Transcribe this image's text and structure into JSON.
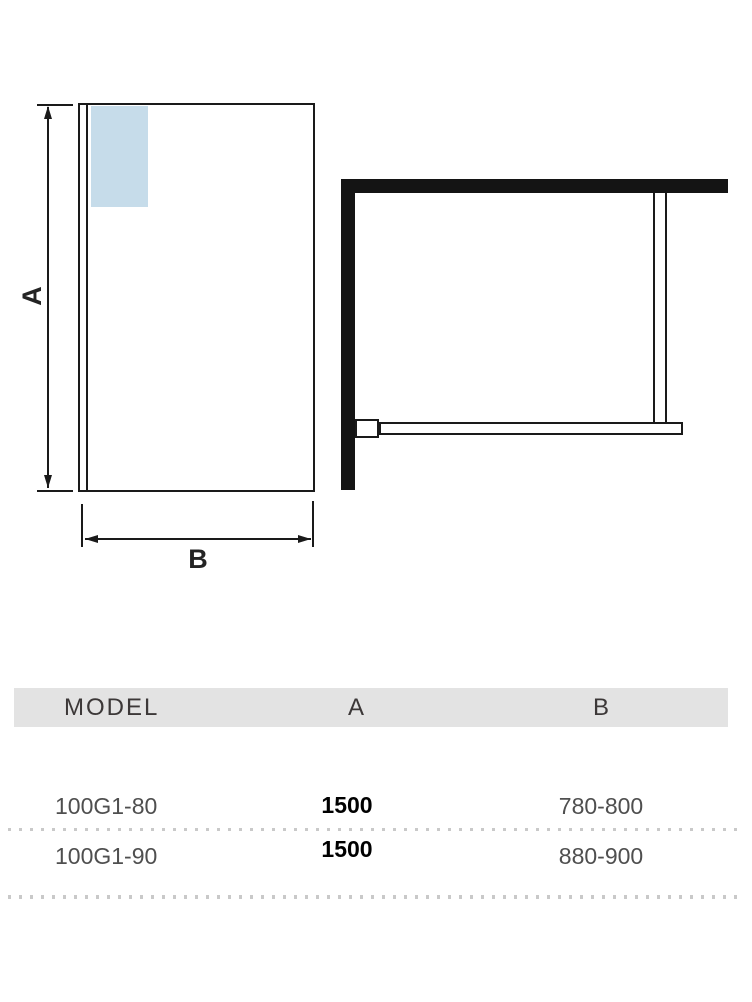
{
  "front_view": {
    "dim_a_label": "A",
    "dim_b_label": "B"
  },
  "table": {
    "headers": {
      "model": "MODEL",
      "a": "A",
      "b": "B"
    },
    "rows": [
      {
        "model": "100G1-80",
        "a": "1500",
        "b": "780-800"
      },
      {
        "model": "100G1-90",
        "a": "1500",
        "b": "880-900"
      }
    ]
  },
  "colors": {
    "line": "#1a1a1a",
    "wall_fill": "#141414",
    "glass_highlight": "#c6dcea",
    "header_band": "#e3e3e3",
    "row_text": "#4f4f4f",
    "value_text": "#000000"
  }
}
